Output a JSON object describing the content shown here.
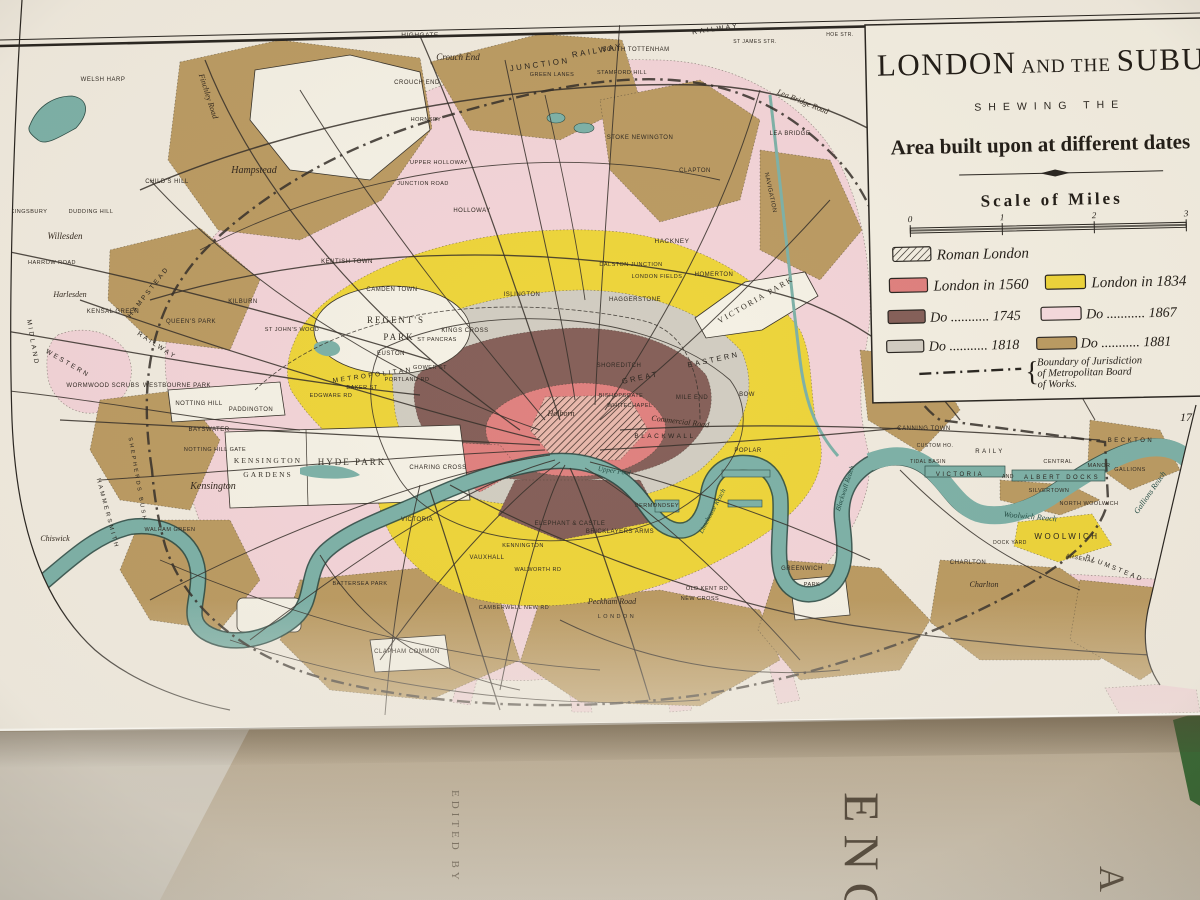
{
  "title": "LONDON AND THE SUBURBS",
  "palette": {
    "paper": "#f1ebdf",
    "paper2": "#f3eee1",
    "pink": "#f3d4d8",
    "yellow": "#eed53c",
    "tan": "#bc9c64",
    "brown": "#86615a",
    "grey": "#d2cdc2",
    "red": "#e08280",
    "teal": "#7fb2a8",
    "tealdark": "#3f6e66",
    "ink": "#2b2620",
    "underpage": "#c3b49a",
    "covergreen": "#3c6b38"
  },
  "cartouche": {
    "title_1": "LONDON",
    "title_2": " AND THE ",
    "title_3": "SUBURBS",
    "subtitle": "SHEWING THE",
    "heading": "Area built upon at different dates",
    "scale_title": "Scale of Miles",
    "scale_ticks": [
      "0",
      "1",
      "2",
      "3"
    ]
  },
  "legend": {
    "roman_label": "Roman London",
    "brace": "{",
    "items": [
      {
        "label": "London in 1560",
        "color": "#e08280"
      },
      {
        "label": "London in 1834",
        "color": "#eed53c"
      },
      {
        "label": "Do ........... 1745",
        "color": "#86615a"
      },
      {
        "label": "Do ........... 1867",
        "color": "#f6dbde"
      },
      {
        "label": "Do ........... 1818",
        "color": "#d2cdc2"
      },
      {
        "label": "Do ........... 1881",
        "color": "#bc9c64"
      }
    ],
    "boundary": [
      "Boundary of Jurisdiction",
      "of Metropolitan Board",
      "of Works."
    ]
  },
  "map": {
    "plate_number": "17",
    "labels": [
      {
        "t": "HIGHGATE",
        "x": 420,
        "y": 37,
        "s": 6.5,
        "st": "c"
      },
      {
        "t": "Crouch End",
        "x": 458,
        "y": 60,
        "s": 9,
        "st": "i"
      },
      {
        "t": "CROUCH END",
        "x": 417,
        "y": 84,
        "s": 6,
        "st": "c"
      },
      {
        "t": "JUNCTION",
        "x": 540,
        "y": 67,
        "r": -8,
        "s": 8,
        "st": "w"
      },
      {
        "t": "RAILWAY",
        "x": 598,
        "y": 53,
        "r": -10,
        "s": 8,
        "st": "w"
      },
      {
        "t": "RAILWAY",
        "x": 716,
        "y": 31,
        "r": -8,
        "s": 7,
        "st": "w"
      },
      {
        "t": "SOUTH TOTTENHAM",
        "x": 636,
        "y": 51,
        "s": 6,
        "st": "c"
      },
      {
        "t": "GREEN LANES",
        "x": 552,
        "y": 76,
        "s": 5.5,
        "st": "c"
      },
      {
        "t": "STAMFORD HILL",
        "x": 622,
        "y": 74,
        "s": 5.5,
        "st": "c"
      },
      {
        "t": "Lea Bridge Road",
        "x": 802,
        "y": 104,
        "r": 22,
        "s": 8,
        "st": "i"
      },
      {
        "t": "LEA BRIDGE",
        "x": 790,
        "y": 135,
        "s": 6,
        "st": "c"
      },
      {
        "t": "NAVIGATION",
        "x": 769,
        "y": 193,
        "r": 78,
        "s": 6,
        "st": "c"
      },
      {
        "t": "CLAPTON",
        "x": 695,
        "y": 172,
        "s": 6,
        "st": "c"
      },
      {
        "t": "STOKE NEWINGTON",
        "x": 640,
        "y": 139,
        "s": 6,
        "st": "c"
      },
      {
        "t": "HACKNEY",
        "x": 672,
        "y": 243,
        "s": 6.5,
        "st": "c"
      },
      {
        "t": "HOMERTON",
        "x": 714,
        "y": 276,
        "s": 6,
        "st": "c"
      },
      {
        "t": "Hampstead",
        "x": 254,
        "y": 173,
        "s": 10,
        "st": "i"
      },
      {
        "t": "CHILD'S HILL",
        "x": 167,
        "y": 183,
        "s": 6,
        "st": "c"
      },
      {
        "t": "WELSH HARP",
        "x": 103,
        "y": 81,
        "s": 6,
        "st": "c"
      },
      {
        "t": "KINGSBURY",
        "x": 29,
        "y": 213,
        "s": 5.5,
        "st": "c"
      },
      {
        "t": "DUDDING HILL",
        "x": 91,
        "y": 213,
        "s": 5.5,
        "st": "c"
      },
      {
        "t": "Willesden",
        "x": 65,
        "y": 239,
        "s": 9,
        "st": "i"
      },
      {
        "t": "HARROW ROAD",
        "x": 52,
        "y": 264,
        "s": 5.5,
        "st": "c"
      },
      {
        "t": "Harlesden",
        "x": 70,
        "y": 297,
        "s": 8,
        "st": "i"
      },
      {
        "t": "KENSAL GREEN",
        "x": 113,
        "y": 313,
        "s": 6,
        "st": "c"
      },
      {
        "t": "QUEEN'S PARK",
        "x": 191,
        "y": 323,
        "s": 6,
        "st": "c"
      },
      {
        "t": "HAMPSTEAD",
        "x": 150,
        "y": 293,
        "r": -52,
        "s": 6.5,
        "st": "w"
      },
      {
        "t": "MIDLAND",
        "x": 31,
        "y": 343,
        "r": 80,
        "s": 6.5,
        "st": "w"
      },
      {
        "t": "WESTERN",
        "x": 67,
        "y": 365,
        "r": 30,
        "s": 6.5,
        "st": "w"
      },
      {
        "t": "RAILWAY",
        "x": 156,
        "y": 347,
        "r": 33,
        "s": 6.5,
        "st": "w"
      },
      {
        "t": "Finchley Road",
        "x": 206,
        "y": 97,
        "r": 72,
        "s": 8,
        "st": "i"
      },
      {
        "t": "HORNSEY",
        "x": 426,
        "y": 121,
        "s": 5.5,
        "st": "c"
      },
      {
        "t": "UPPER HOLLOWAY",
        "x": 439,
        "y": 164,
        "s": 5.5,
        "st": "c"
      },
      {
        "t": "JUNCTION ROAD",
        "x": 423,
        "y": 185,
        "s": 5.5,
        "st": "c"
      },
      {
        "t": "HOLLOWAY",
        "x": 472,
        "y": 212,
        "s": 6,
        "st": "c"
      },
      {
        "t": "KENTISH TOWN",
        "x": 347,
        "y": 263,
        "s": 6,
        "st": "c"
      },
      {
        "t": "CAMDEN TOWN",
        "x": 392,
        "y": 291,
        "s": 6,
        "st": "c"
      },
      {
        "t": "KILBURN",
        "x": 243,
        "y": 303,
        "s": 6,
        "st": "c"
      },
      {
        "t": "ST JOHN'S WOOD",
        "x": 292,
        "y": 331,
        "s": 5.5,
        "st": "c"
      },
      {
        "t": "ISLINGTON",
        "x": 522,
        "y": 296,
        "s": 6,
        "st": "c"
      },
      {
        "t": "DALSTON JUNCTION",
        "x": 631,
        "y": 266,
        "s": 5.5,
        "st": "c"
      },
      {
        "t": "LONDON FIELDS",
        "x": 657,
        "y": 278,
        "s": 5.5,
        "st": "c"
      },
      {
        "t": "HAGGERSTONE",
        "x": 635,
        "y": 301,
        "s": 6,
        "st": "c"
      },
      {
        "t": "VICTORIA PARK",
        "x": 757,
        "y": 302,
        "r": -30,
        "s": 8,
        "st": "p"
      },
      {
        "t": "WORMWOOD SCRUBS",
        "x": 103,
        "y": 387,
        "s": 6,
        "st": "c"
      },
      {
        "t": "WESTBOURNE PARK",
        "x": 177,
        "y": 387,
        "s": 6,
        "st": "c"
      },
      {
        "t": "NOTTING HILL",
        "x": 199,
        "y": 405,
        "s": 6,
        "st": "c"
      },
      {
        "t": "PADDINGTON",
        "x": 251,
        "y": 411,
        "s": 6,
        "st": "c"
      },
      {
        "t": "BAYSWATER",
        "x": 209,
        "y": 431,
        "s": 6,
        "st": "c"
      },
      {
        "t": "NOTTING HILL GATE",
        "x": 215,
        "y": 451,
        "s": 5.5,
        "st": "c"
      },
      {
        "t": "KENSINGTON",
        "x": 268,
        "y": 463,
        "s": 7.5,
        "st": "p"
      },
      {
        "t": "GARDENS",
        "x": 268,
        "y": 477,
        "s": 7.5,
        "st": "p"
      },
      {
        "t": "Kensington",
        "x": 213,
        "y": 489,
        "s": 10,
        "st": "i"
      },
      {
        "t": "HYDE PARK",
        "x": 352,
        "y": 465,
        "s": 9,
        "st": "p"
      },
      {
        "t": "REGENT'S",
        "x": 396,
        "y": 323,
        "s": 9,
        "st": "p"
      },
      {
        "t": "PARK",
        "x": 399,
        "y": 340,
        "s": 9,
        "st": "p"
      },
      {
        "t": "EUSTON",
        "x": 391,
        "y": 355,
        "s": 6,
        "st": "c"
      },
      {
        "t": "GOWER ST",
        "x": 430,
        "y": 369,
        "s": 5.5,
        "st": "c"
      },
      {
        "t": "PORTLAND RD",
        "x": 407,
        "y": 381,
        "s": 5.5,
        "st": "c"
      },
      {
        "t": "BAKER ST",
        "x": 362,
        "y": 389,
        "s": 5.5,
        "st": "c"
      },
      {
        "t": "EDGWARE RD",
        "x": 331,
        "y": 397,
        "s": 5.5,
        "st": "c"
      },
      {
        "t": "METROPOLITAN",
        "x": 373,
        "y": 377,
        "r": -8,
        "s": 6.5,
        "st": "w"
      },
      {
        "t": "KINGS CROSS",
        "x": 465,
        "y": 332,
        "s": 6,
        "st": "c"
      },
      {
        "t": "ST PANCRAS",
        "x": 437,
        "y": 341,
        "s": 5.5,
        "st": "c"
      },
      {
        "t": "SHOREDITCH",
        "x": 619,
        "y": 367,
        "s": 6,
        "st": "c"
      },
      {
        "t": "GREAT",
        "x": 641,
        "y": 380,
        "r": -12,
        "s": 7.5,
        "st": "w"
      },
      {
        "t": "EASTERN",
        "x": 714,
        "y": 362,
        "r": -12,
        "s": 7.5,
        "st": "w"
      },
      {
        "t": "BISHOPSGATE",
        "x": 621,
        "y": 397,
        "s": 5.5,
        "st": "c"
      },
      {
        "t": "WHITECHAPEL",
        "x": 630,
        "y": 407,
        "s": 5.5,
        "st": "c"
      },
      {
        "t": "Holborn",
        "x": 561,
        "y": 416,
        "s": 8,
        "st": "i"
      },
      {
        "t": "MILE END",
        "x": 692,
        "y": 399,
        "s": 6,
        "st": "c"
      },
      {
        "t": "BOW",
        "x": 747,
        "y": 396,
        "s": 6,
        "st": "c"
      },
      {
        "t": "Commercial Road",
        "x": 680,
        "y": 424,
        "r": 7,
        "s": 8,
        "st": "i"
      },
      {
        "t": "BLACKWALL",
        "x": 665,
        "y": 438,
        "s": 6.5,
        "st": "w"
      },
      {
        "t": "POPLAR",
        "x": 748,
        "y": 452,
        "s": 6,
        "st": "c"
      },
      {
        "t": "CHARING CROSS",
        "x": 438,
        "y": 469,
        "s": 6,
        "st": "c"
      },
      {
        "t": "Upper Pool",
        "x": 614,
        "y": 473,
        "r": 8,
        "s": 7,
        "st": "r"
      },
      {
        "t": "VICTORIA",
        "x": 417,
        "y": 521,
        "s": 6,
        "st": "c"
      },
      {
        "t": "VAUXHALL",
        "x": 487,
        "y": 559,
        "s": 6,
        "st": "c"
      },
      {
        "t": "KENNINGTON",
        "x": 523,
        "y": 547,
        "s": 5.5,
        "st": "c"
      },
      {
        "t": "ELEPHANT & CASTLE",
        "x": 570,
        "y": 525,
        "s": 6,
        "st": "c"
      },
      {
        "t": "BRICKLAYERS ARMS",
        "x": 620,
        "y": 533,
        "s": 6,
        "st": "c"
      },
      {
        "t": "BERMONDSEY",
        "x": 657,
        "y": 507,
        "s": 5.5,
        "st": "c"
      },
      {
        "t": "WALWORTH RD",
        "x": 538,
        "y": 571,
        "s": 5.5,
        "st": "c"
      },
      {
        "t": "OLD KENT RD",
        "x": 707,
        "y": 590,
        "s": 5.5,
        "st": "c"
      },
      {
        "t": "NEW CROSS",
        "x": 700,
        "y": 600,
        "s": 5.5,
        "st": "c"
      },
      {
        "t": "Peckham Road",
        "x": 612,
        "y": 604,
        "s": 8,
        "st": "i"
      },
      {
        "t": "CAMBERWELL NEW RD",
        "x": 514,
        "y": 609,
        "s": 5.5,
        "st": "c"
      },
      {
        "t": "LONDON",
        "x": 617,
        "y": 618,
        "s": 5.5,
        "st": "w"
      },
      {
        "t": "CLAPHAM COMMON",
        "x": 407,
        "y": 653,
        "s": 6,
        "st": "c"
      },
      {
        "t": "BATTERSEA PARK",
        "x": 360,
        "y": 585,
        "s": 5.5,
        "st": "c"
      },
      {
        "t": "Limehouse Reach",
        "x": 714,
        "y": 512,
        "r": -62,
        "s": 7,
        "st": "r"
      },
      {
        "t": "GREENWICH",
        "x": 802,
        "y": 570,
        "s": 6,
        "st": "c"
      },
      {
        "t": "PARK",
        "x": 812,
        "y": 586,
        "s": 5.5,
        "st": "c"
      },
      {
        "t": "Blackwall Reach",
        "x": 847,
        "y": 489,
        "r": -72,
        "s": 7,
        "st": "r"
      },
      {
        "t": "CANNING TOWN",
        "x": 924,
        "y": 430,
        "s": 6,
        "st": "c"
      },
      {
        "t": "CUSTOM HO.",
        "x": 935,
        "y": 447,
        "s": 5,
        "st": "c"
      },
      {
        "t": "TIDAL BASIN",
        "x": 928,
        "y": 463,
        "s": 5,
        "st": "c"
      },
      {
        "t": "RAILY",
        "x": 990,
        "y": 453,
        "s": 6,
        "st": "w"
      },
      {
        "t": "VICTORIA",
        "x": 960,
        "y": 476,
        "s": 6,
        "st": "w"
      },
      {
        "t": "AND",
        "x": 1008,
        "y": 478,
        "s": 5,
        "st": "c"
      },
      {
        "t": "ALBERT DOCKS",
        "x": 1062,
        "y": 479,
        "s": 6,
        "st": "w"
      },
      {
        "t": "CENTRAL",
        "x": 1058,
        "y": 463,
        "s": 5.5,
        "st": "c"
      },
      {
        "t": "MANOR",
        "x": 1099,
        "y": 467,
        "s": 5.5,
        "st": "c"
      },
      {
        "t": "GALLIONS",
        "x": 1130,
        "y": 471,
        "s": 5.5,
        "st": "c"
      },
      {
        "t": "BECKTON",
        "x": 1131,
        "y": 442,
        "s": 6,
        "st": "w"
      },
      {
        "t": "SILVERTOWN",
        "x": 1049,
        "y": 492,
        "s": 5.5,
        "st": "c"
      },
      {
        "t": "NORTH WOOLWICH",
        "x": 1089,
        "y": 505,
        "s": 5.5,
        "st": "c"
      },
      {
        "t": "Woolwich Reach",
        "x": 1030,
        "y": 519,
        "r": 5,
        "s": 8,
        "st": "r"
      },
      {
        "t": "Gallions Reach",
        "x": 1152,
        "y": 494,
        "r": -55,
        "s": 8,
        "st": "r"
      },
      {
        "t": "DOCK YARD",
        "x": 1010,
        "y": 544,
        "s": 5,
        "st": "c"
      },
      {
        "t": "WOOLWICH",
        "x": 1067,
        "y": 539,
        "s": 8,
        "st": "w"
      },
      {
        "t": "ARSENAL",
        "x": 1080,
        "y": 560,
        "r": 12,
        "s": 5.5,
        "st": "c"
      },
      {
        "t": "CHARLTON",
        "x": 968,
        "y": 564,
        "s": 6,
        "st": "c"
      },
      {
        "t": "Charlton",
        "x": 984,
        "y": 587,
        "s": 8,
        "st": "i"
      },
      {
        "t": "PLUMSTEAD",
        "x": 1114,
        "y": 570,
        "r": 22,
        "s": 6.5,
        "st": "w"
      },
      {
        "t": "HAMMERSMITH",
        "x": 106,
        "y": 514,
        "r": 75,
        "s": 6,
        "st": "w"
      },
      {
        "t": "SHEPHERDS BUSH",
        "x": 136,
        "y": 480,
        "r": 80,
        "s": 5.5,
        "st": "w"
      },
      {
        "t": "WALHAM GREEN",
        "x": 170,
        "y": 531,
        "s": 5.5,
        "st": "c"
      },
      {
        "t": "Chiswick",
        "x": 55,
        "y": 541,
        "s": 8,
        "st": "i"
      },
      {
        "t": "ST JAMES STR.",
        "x": 755,
        "y": 43,
        "s": 5,
        "st": "c"
      },
      {
        "t": "HOE STR.",
        "x": 840,
        "y": 36,
        "s": 5,
        "st": "c"
      },
      {
        "t": "HOE STR.",
        "x": 1139,
        "y": 9,
        "s": 6,
        "st": "c"
      }
    ]
  },
  "book": {
    "spine_text": "EDITED BY",
    "title_fragment": "ENC",
    "letter_fragment": "A"
  }
}
